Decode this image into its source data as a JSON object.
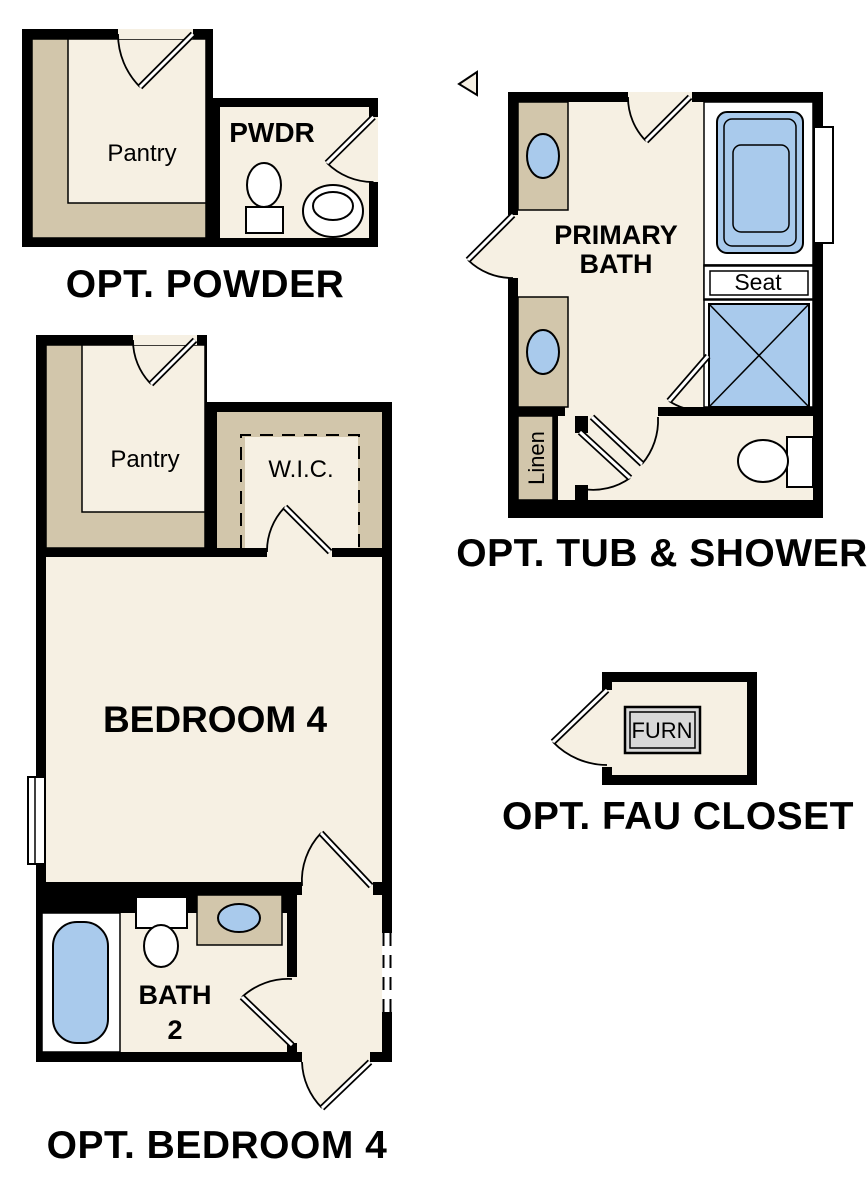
{
  "colors": {
    "cream": "#f6f0e3",
    "tan": "#d2c6ab",
    "blue": "#a9caec",
    "wall": "#000000",
    "gray": "#d9d9d9",
    "ink": "#000000"
  },
  "plans": {
    "powder": {
      "title": "OPT. POWDER",
      "pantry_label": "Pantry",
      "pwdr_label": "PWDR"
    },
    "tub_shower": {
      "title": "OPT. TUB & SHOWER",
      "room_line1": "PRIMARY",
      "room_line2": "BATH",
      "seat_label": "Seat",
      "linen_label": "Linen"
    },
    "bedroom4": {
      "title": "OPT. BEDROOM 4",
      "pantry_label": "Pantry",
      "wic_label": "W.I.C.",
      "bedroom_label": "BEDROOM 4",
      "bath_line1": "BATH",
      "bath_line2": "2"
    },
    "fau_closet": {
      "title": "OPT. FAU CLOSET",
      "furn_label": "FURN"
    }
  }
}
